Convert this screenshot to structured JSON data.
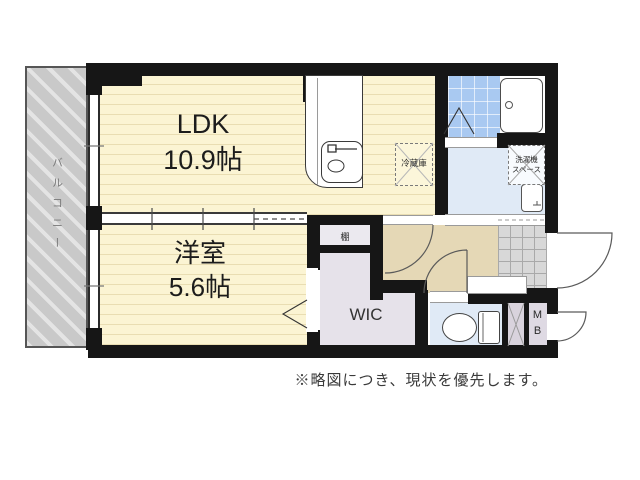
{
  "plan": {
    "rooms": {
      "ldk": {
        "name": "LDK",
        "size": "10.9帖"
      },
      "western_room": {
        "name": "洋室",
        "size": "5.6帖"
      },
      "wic": {
        "label": "WIC"
      },
      "balcony": {
        "label": "バルコニー"
      },
      "shelf": {
        "label": "棚"
      },
      "meter_box": {
        "line1": "M",
        "line2": "B"
      }
    },
    "fixtures": {
      "refrigerator": {
        "label": "冷蔵庫"
      },
      "laundry_space": {
        "line1": "洗濯機",
        "line2": "スペース"
      }
    },
    "note": "※略図につき、現状を優先します。",
    "colors": {
      "wall": "#161616",
      "flooring": "#fbf4d3",
      "flooring_line": "#e9ddb2",
      "balcony": "#c9c9c9",
      "bath_tile": "#a9c9f1",
      "wet_floor": "#e0eaf6",
      "hallway": "#e5d8b6",
      "wic": "#e6e2ea",
      "genkan_tile": "#d8d8d8",
      "background": "#ffffff"
    }
  }
}
